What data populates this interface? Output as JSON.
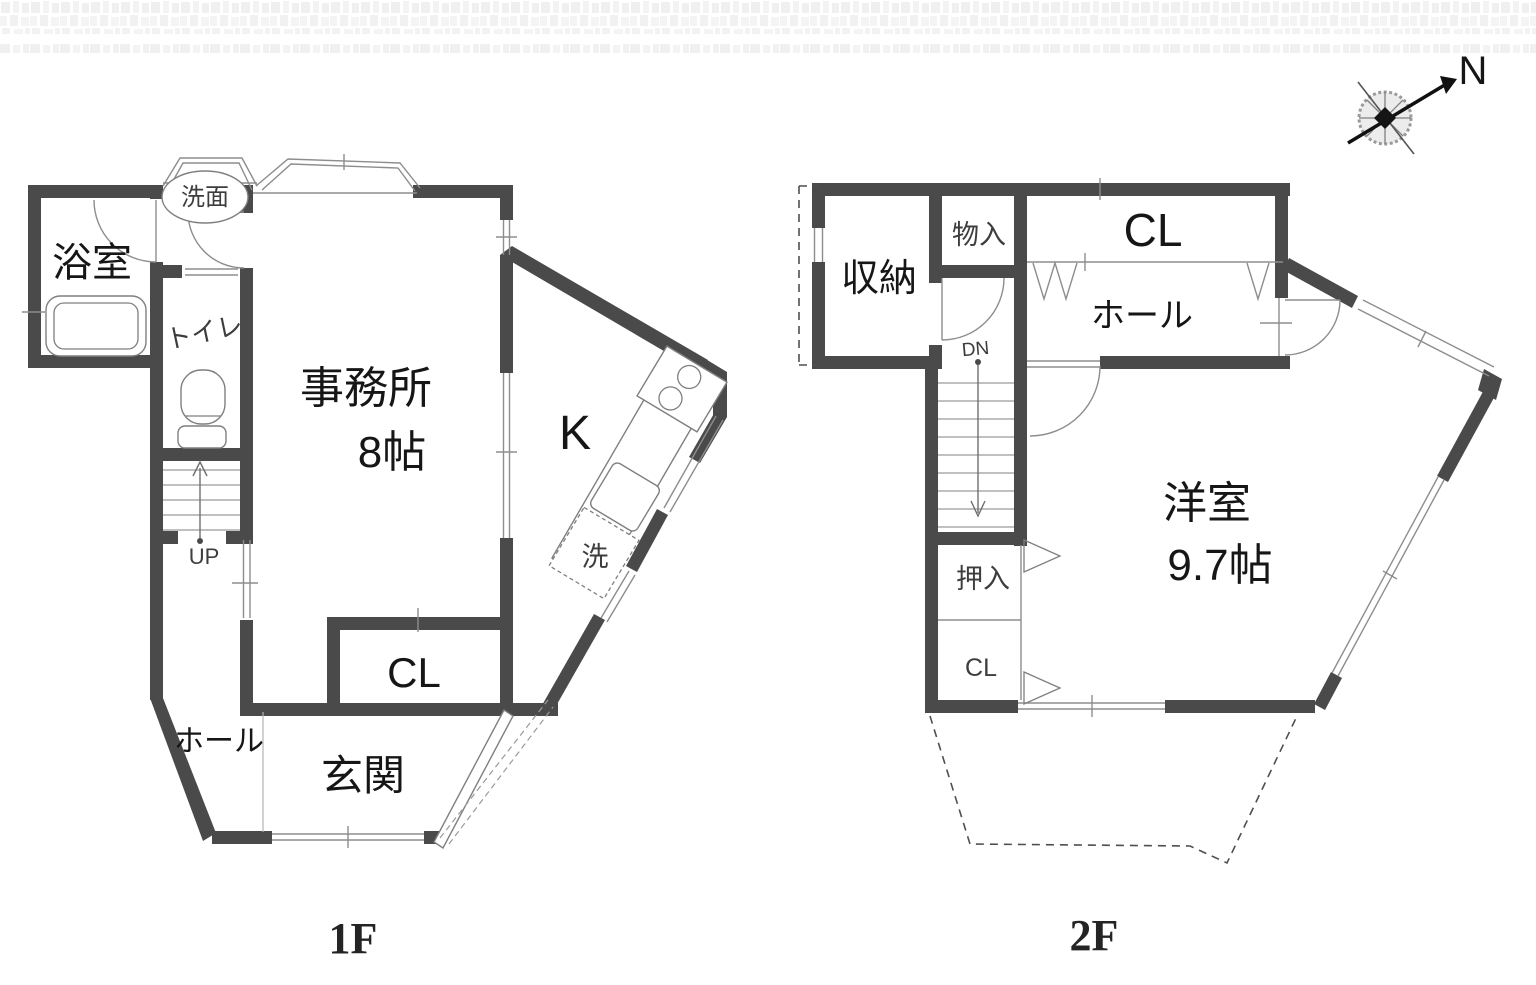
{
  "colors": {
    "wall": "#4a4a4a",
    "line": "#8d8d8d",
    "background": "#ffffff"
  },
  "compass": {
    "north_label": "N"
  },
  "floor1": {
    "floor_label": "1F",
    "bathroom": "浴室",
    "washstand": "洗面",
    "toilet": "トイレ",
    "office": "事務所",
    "office_size": "8帖",
    "kitchen": "K",
    "laundry": "洗",
    "closet": "CL",
    "hall": "ホール",
    "entrance": "玄関",
    "stairs_up": "UP"
  },
  "floor2": {
    "floor_label": "2F",
    "storage": "収納",
    "small_storage": "物入",
    "closet": "CL",
    "hall": "ホール",
    "stairs_down": "DN",
    "western_room": "洋室",
    "western_room_size": "9.7帖",
    "oshiire": "押入",
    "oshiire_closet": "CL"
  }
}
